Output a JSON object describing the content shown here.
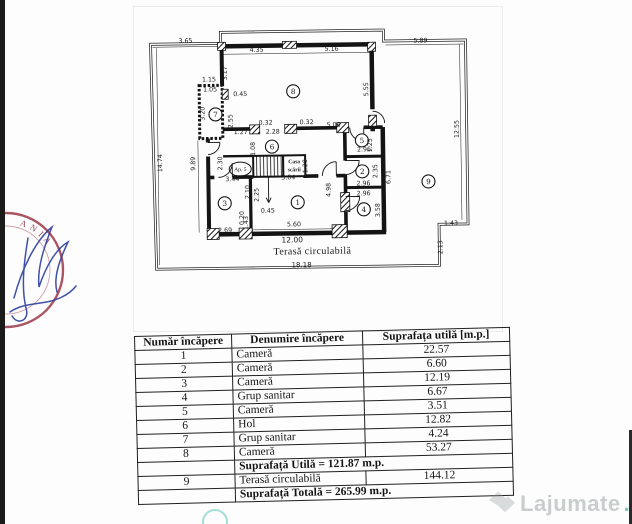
{
  "floorplan": {
    "apartment_label": "Ap. 5",
    "staircase_label": [
      "Casa",
      "scării"
    ],
    "terrace_label": "Terasă circulabilă",
    "room_markers": [
      {
        "n": "1",
        "x": 297,
        "y": 202
      },
      {
        "n": "2",
        "x": 362,
        "y": 172
      },
      {
        "n": "3",
        "x": 224,
        "y": 202
      },
      {
        "n": "4",
        "x": 363,
        "y": 210
      },
      {
        "n": "5",
        "x": 362,
        "y": 141
      },
      {
        "n": "6",
        "x": 272,
        "y": 146
      },
      {
        "n": "7",
        "x": 216,
        "y": 113
      },
      {
        "n": "8",
        "x": 294,
        "y": 91
      },
      {
        "n": "9",
        "x": 428,
        "y": 183
      }
    ],
    "dimensions": [
      {
        "t": "3.65",
        "x": 187,
        "y": 41,
        "r": 0
      },
      {
        "t": "4.35",
        "x": 258,
        "y": 51,
        "r": 0
      },
      {
        "t": "5.16",
        "x": 333,
        "y": 51,
        "r": 0
      },
      {
        "t": "5.89",
        "x": 422,
        "y": 44,
        "r": 0
      },
      {
        "t": "3.17",
        "x": 228,
        "y": 72,
        "r": -90
      },
      {
        "t": "1.15",
        "x": 210,
        "y": 80,
        "r": 0
      },
      {
        "t": "1.05",
        "x": 211,
        "y": 90,
        "r": 0
      },
      {
        "t": "0.45",
        "x": 241,
        "y": 95,
        "r": 0
      },
      {
        "t": "3.20",
        "x": 205,
        "y": 112,
        "r": -90
      },
      {
        "t": "2.55",
        "x": 233,
        "y": 120,
        "r": -90
      },
      {
        "t": "5.55",
        "x": 369,
        "y": 90,
        "r": -90
      },
      {
        "t": "12.55",
        "x": 459,
        "y": 131,
        "r": -90
      },
      {
        "t": "14.74",
        "x": 162,
        "y": 161,
        "r": -90
      },
      {
        "t": "9.89",
        "x": 195,
        "y": 162,
        "r": -90
      },
      {
        "t": "2.30",
        "x": 222,
        "y": 162,
        "r": -90
      },
      {
        "t": "1.27",
        "x": 241,
        "y": 133,
        "r": 0
      },
      {
        "t": "0.32",
        "x": 266,
        "y": 124,
        "r": 0
      },
      {
        "t": "2.28",
        "x": 273,
        "y": 133,
        "r": 0
      },
      {
        "t": "0.32",
        "x": 307,
        "y": 124,
        "r": 0
      },
      {
        "t": "5.06",
        "x": 334,
        "y": 127,
        "r": 0
      },
      {
        "t": "1.08",
        "x": 255,
        "y": 148,
        "r": -90
      },
      {
        "t": "1.20",
        "x": 307,
        "y": 166,
        "r": -90
      },
      {
        "t": "1.25",
        "x": 372,
        "y": 146,
        "r": -90
      },
      {
        "t": "2.96",
        "x": 364,
        "y": 152,
        "r": 0
      },
      {
        "t": "2.35",
        "x": 377,
        "y": 172,
        "r": -90
      },
      {
        "t": "6.71",
        "x": 390,
        "y": 178,
        "r": -90
      },
      {
        "t": "2.96",
        "x": 363,
        "y": 186,
        "r": 0
      },
      {
        "t": "2.96",
        "x": 363,
        "y": 196,
        "r": 0
      },
      {
        "t": "3.58",
        "x": 379,
        "y": 211,
        "r": -90
      },
      {
        "t": "4.98",
        "x": 330,
        "y": 190,
        "r": -90
      },
      {
        "t": "3.44",
        "x": 232,
        "y": 180,
        "r": 0
      },
      {
        "t": "3.04",
        "x": 288,
        "y": 179,
        "r": 0
      },
      {
        "t": "2.10",
        "x": 249,
        "y": 191,
        "r": -90
      },
      {
        "t": "2.25",
        "x": 258,
        "y": 194,
        "r": -90
      },
      {
        "t": "0.45",
        "x": 267,
        "y": 212,
        "r": 0
      },
      {
        "t": "0.20",
        "x": 243,
        "y": 217,
        "r": -90
      },
      {
        "t": "1.43",
        "x": 247,
        "y": 222,
        "r": -90
      },
      {
        "t": "2.69",
        "x": 224,
        "y": 231,
        "r": 0
      },
      {
        "t": "5.60",
        "x": 293,
        "y": 226,
        "r": 0
      },
      {
        "t": "12.00",
        "x": 291,
        "y": 242,
        "r": 0,
        "s": 7.5
      },
      {
        "t": "18.18",
        "x": 300,
        "y": 267,
        "r": 0,
        "s": 7
      },
      {
        "t": "1.43",
        "x": 450,
        "y": 227,
        "r": 0
      },
      {
        "t": "2.13",
        "x": 441,
        "y": 249,
        "r": -90
      }
    ]
  },
  "stamp": {
    "visible_text": "ANIA"
  },
  "watermark": {
    "text": "Lajumate",
    "suffix": ".ro",
    "suffix_color": "#2aa79b"
  },
  "table": {
    "headers": [
      "Număr încăpere",
      "Denumire încăpere",
      "Suprafața utilă [m.p.]"
    ],
    "rows": [
      {
        "nr": "1",
        "name": "Cameră",
        "area": "22.57"
      },
      {
        "nr": "2",
        "name": "Cameră",
        "area": "6.60"
      },
      {
        "nr": "3",
        "name": "Cameră",
        "area": "12.19"
      },
      {
        "nr": "4",
        "name": "Grup sanitar",
        "area": "6.67"
      },
      {
        "nr": "5",
        "name": "Cameră",
        "area": "3.51"
      },
      {
        "nr": "6",
        "name": "Hol",
        "area": "12.82"
      },
      {
        "nr": "7",
        "name": "Grup sanitar",
        "area": "4.24"
      },
      {
        "nr": "8",
        "name": "Cameră",
        "area": "53.27"
      }
    ],
    "subtotal": "Suprafață Utilă = 121.87 m.p.",
    "terrace_row": {
      "nr": "9",
      "name": "Terasă circulabilă",
      "area": "144.12"
    },
    "total": "Suprafață Totală = 265.99 m.p."
  }
}
